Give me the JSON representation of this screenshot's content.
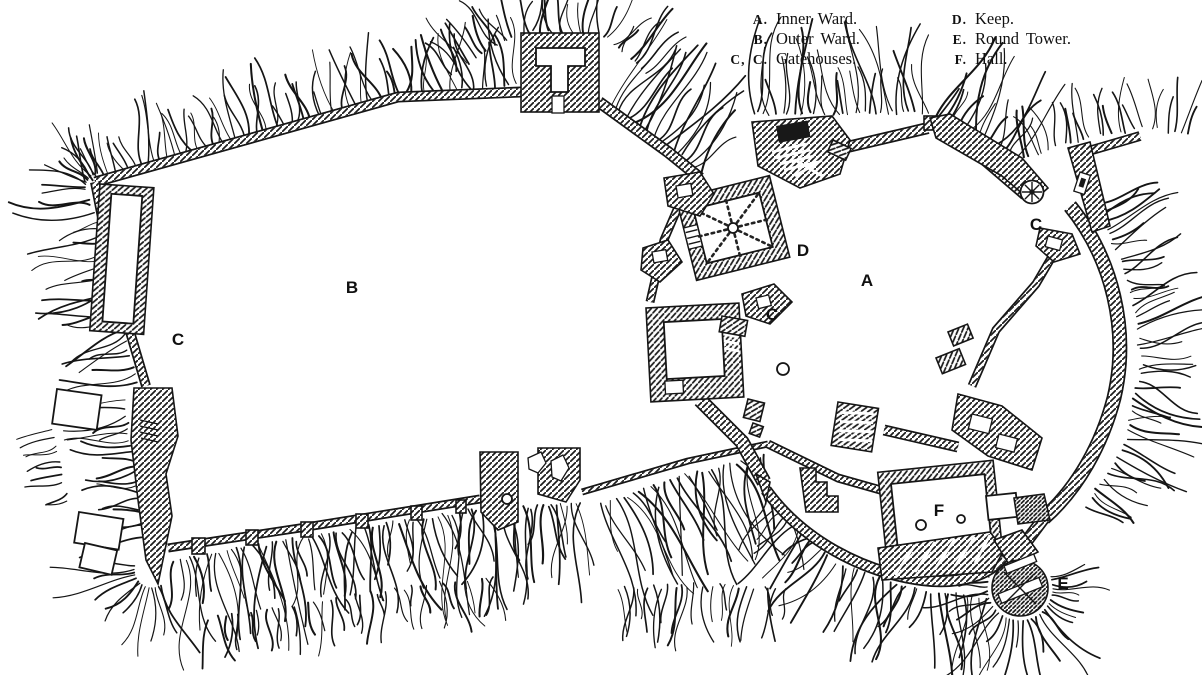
{
  "figure": {
    "background": "#ffffff",
    "ink": "#161616"
  },
  "legend": {
    "columns": [
      {
        "items": [
          {
            "key": "A.",
            "label": "Inner Ward."
          },
          {
            "key": "B.",
            "label": "Outer Ward."
          },
          {
            "key": "C, C.",
            "label": "Gatehouses."
          }
        ]
      },
      {
        "items": [
          {
            "key": "D.",
            "label": "Keep."
          },
          {
            "key": "E.",
            "label": "Round Tower."
          },
          {
            "key": "F.",
            "label": "Hall."
          }
        ]
      }
    ]
  },
  "plan": {
    "labels": [
      {
        "id": "b-outer-ward",
        "text": "B",
        "x": 352,
        "y": 287
      },
      {
        "id": "c-west-gatehouse",
        "text": "C",
        "x": 178,
        "y": 339
      },
      {
        "id": "c-middle-gatehouse",
        "text": "C",
        "x": 772,
        "y": 314
      },
      {
        "id": "d-keep",
        "text": "D",
        "x": 803,
        "y": 250
      },
      {
        "id": "a-inner-ward",
        "text": "A",
        "x": 867,
        "y": 280
      },
      {
        "id": "c-northeast-gatehouse",
        "text": "C",
        "x": 1036,
        "y": 224
      },
      {
        "id": "f-hall",
        "text": "F",
        "x": 939,
        "y": 510
      },
      {
        "id": "e-round-tower",
        "text": "E",
        "x": 1063,
        "y": 583
      }
    ],
    "circles": [
      {
        "id": "courtyard-well",
        "x": 783,
        "y": 369,
        "r": 6
      },
      {
        "id": "hall-pillar-left",
        "x": 921,
        "y": 525,
        "r": 5
      },
      {
        "id": "hall-pillar-right",
        "x": 961,
        "y": 519,
        "r": 4
      },
      {
        "id": "keep-center",
        "x": 733,
        "y": 228,
        "r": 5
      }
    ]
  }
}
